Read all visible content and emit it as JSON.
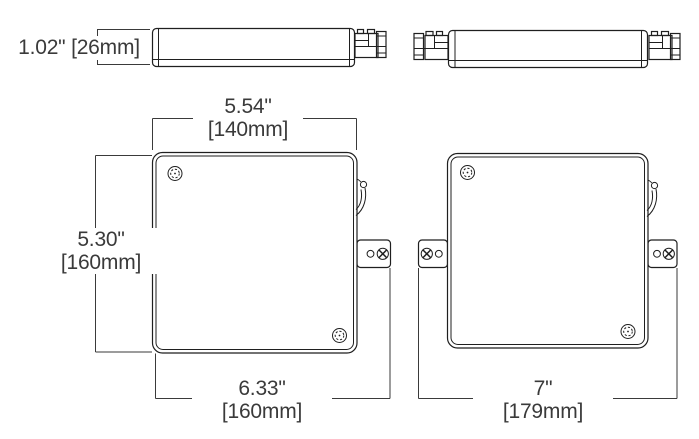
{
  "drawing": {
    "kind": "technical dimension drawing, two product views (side and front) with bracketed inch/millimeter dimensions"
  },
  "dimensions": {
    "thickness": {
      "label": "1.02\" [26mm]",
      "inches": "1.02\"",
      "mm": "[26mm]"
    },
    "body_width": {
      "inches": "5.54\"",
      "mm": "[140mm]"
    },
    "body_height": {
      "inches": "5.30\"",
      "mm": "[160mm]"
    },
    "overall_width_left": {
      "inches": "6.33\"",
      "mm": "[160mm]"
    },
    "overall_width_right": {
      "inches": "7\"",
      "mm": "[179mm]"
    }
  },
  "icons": {
    "corner_screw": "screw-icon",
    "tab_screw": "phillips-screw-icon",
    "tab_hole": "mounting-hole-icon",
    "latch": "release-lever-icon"
  },
  "colors": {
    "background": "#ffffff",
    "line": "#1f1f1f",
    "dimension_line": "#3a3a3a",
    "text": "#3a3a3a"
  }
}
